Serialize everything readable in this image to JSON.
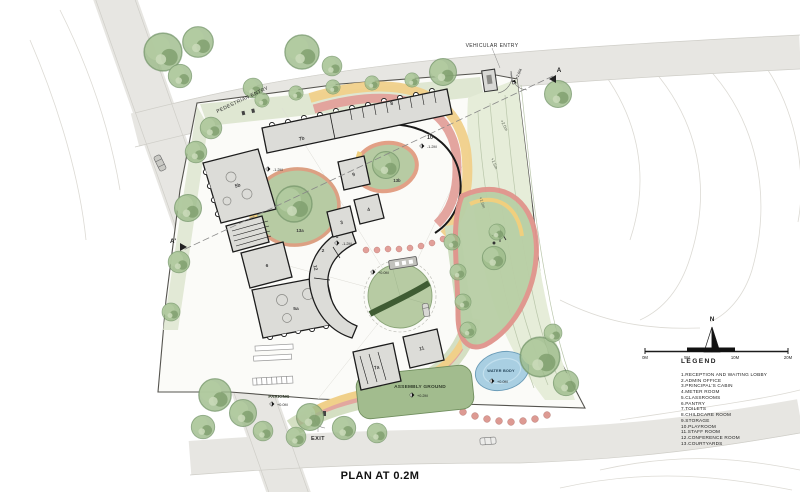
{
  "title": "PLAN AT 0.2M",
  "legend": {
    "heading": "LEGEND",
    "items": [
      "1.RECEPTION AND WAITING LOBBY",
      "2.ADMIN OFFICE",
      "3.PRINCIPAL'S CABIN",
      "4.METER ROOM",
      "5.CLASSROOMS",
      "6.PANTRY",
      "7.TOILETS",
      "8.CHILDCARE ROOM",
      "9.STORAGE",
      "10.PLAYROOM",
      "11.STAFF ROOM",
      "12.CONFERENCE ROOM",
      "13.COURTYARDS"
    ]
  },
  "scale_bar": {
    "labels": [
      "0M",
      "5M",
      "10M",
      "20M"
    ]
  },
  "north_arrow": {
    "label": "N"
  },
  "entries": {
    "vehicular": "VEHICULAR ENTRY",
    "pedestrian": "PEDESTRIAN ENTRY",
    "exit": "EXIT"
  },
  "areas": {
    "parking": "PARKING",
    "assembly_ground": "ASSEMBLY GROUND",
    "water_body": "WATER BODY"
  },
  "rooms": {
    "reception": "1",
    "admin": "2",
    "principal": "3",
    "meter": "4",
    "classroom_a": "5a",
    "classroom_b": "5b",
    "pantry": "6",
    "toilets_a": "7a",
    "toilets_b": "7b",
    "childcare": "8",
    "storage": "9",
    "playroom": "10",
    "staff": "11",
    "conference": "12",
    "courtyard_a": "13a",
    "courtyard_b": "13b"
  },
  "levels": {
    "entry": "+2.0M",
    "playroom": "-1.2M",
    "courtyard": "-1.2M",
    "reception": "-1.2M",
    "plaza": "+0.0M",
    "parking": "+0.0M",
    "assembly": "+0.2M",
    "water": "+0.0M"
  },
  "contours": {
    "c20": "+2.0m",
    "c15": "+1.5m",
    "c10": "+1.0m"
  },
  "sections": {
    "a": "A",
    "a2": "A'"
  },
  "colors": {
    "road": "#e7e6e2",
    "site": "#fbfbf8",
    "green_strip": "#dfe7d2",
    "courtyard_green": "#b7cba3",
    "tree": "#8fae7e",
    "ring_pink": "#e2a09a",
    "band_yellow": "#f0d08a",
    "water": "#a9cfe2",
    "assembly": "#a2bc8e",
    "building": "#dcdcd8",
    "wall": "#1c1c1c"
  }
}
